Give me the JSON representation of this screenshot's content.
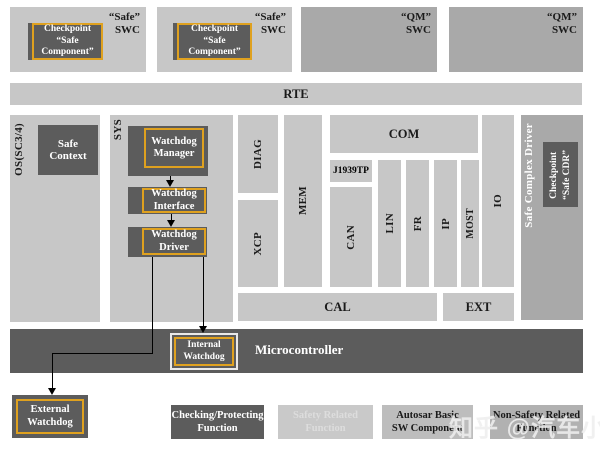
{
  "colors": {
    "light_gray": "#c7c7c7",
    "medium_gray": "#a9a9a9",
    "dark_gray": "#5c5c5c",
    "gold_border": "#dfa11f",
    "connector_black": "#000000",
    "internal_watchdog_frame": "#e9e9e9"
  },
  "top": {
    "swc": [
      {
        "label": "“Safe”\nSWC",
        "checkpoint": "Checkpoint\n“Safe Component”"
      },
      {
        "label": "“Safe”\nSWC",
        "checkpoint": "Checkpoint\n“Safe Component”"
      },
      {
        "label": "“QM”\nSWC"
      },
      {
        "label": "“QM”\nSWC"
      }
    ]
  },
  "rte": "RTE",
  "os_section": {
    "os_label": "OS(SC3/4)",
    "safe_context": "Safe Context"
  },
  "sys_section": {
    "label": "SYS",
    "watchdog_manager": "Watchdog\nManager",
    "watchdog_interface": "Watchdog\nInterface",
    "watchdog_driver": "Watchdog\nDriver"
  },
  "bsw": {
    "diag": "DIAG",
    "xcp": "XCP",
    "mem": "MEM",
    "com": "COM",
    "j1939tp": "J1939TP",
    "can": "CAN",
    "lin": "LIN",
    "fr": "FR",
    "ip": "IP",
    "most": "MOST",
    "io": "IO",
    "cal": "CAL",
    "ext": "EXT"
  },
  "cdd": {
    "safe_complex_driver": "Safe Complex Driver",
    "checkpoint_cdr": "Checkpoint\n“Safe CDR”"
  },
  "mcu": {
    "label": "Microcontroller",
    "internal_watchdog": "Internal\nWatchdog"
  },
  "external_watchdog": "External\nWatchdog",
  "legend": [
    {
      "label": "Checking/Protecting\nFunction"
    },
    {
      "label": "Safety Related\nFunction"
    },
    {
      "label": "Autosar Basic\nSW Component"
    },
    {
      "label": "Non-Safety Related\nFunction"
    }
  ],
  "watermark": "知乎 @汽车小T"
}
